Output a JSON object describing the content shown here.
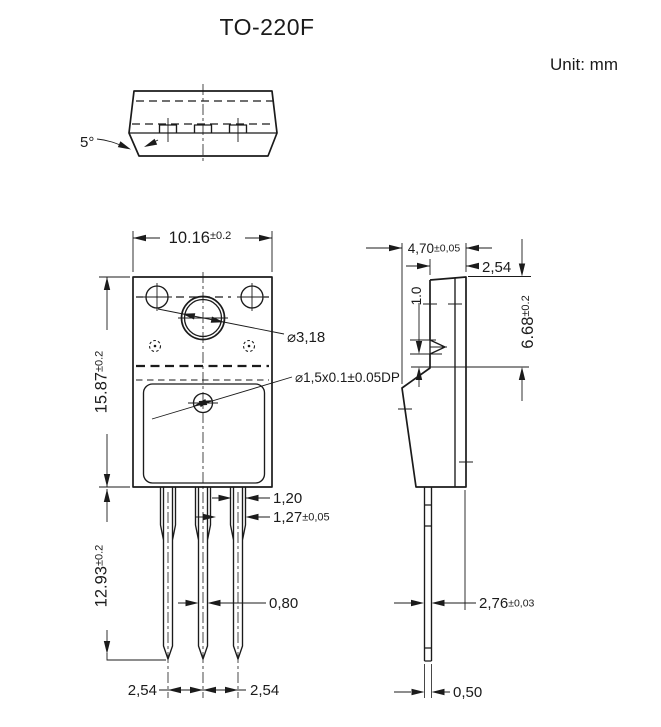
{
  "header": {
    "title": "TO-220F",
    "unit_label": "Unit: mm"
  },
  "top_view": {
    "draft_angle_label": "5°"
  },
  "front_view": {
    "width_dim": {
      "value": "10.16",
      "tol": "±0.2"
    },
    "body_height_dim": {
      "value": "15.87",
      "tol": "±0.2"
    },
    "lead_length_dim": {
      "value": "12.93",
      "tol": "±0.2"
    },
    "mounting_hole_label": "⌀3,18",
    "dimple_label": "⌀1,5x0.1±0.05DP",
    "lead_base_width_dim": "1,20",
    "lead_shoulder_width_dim": {
      "value": "1,27",
      "tol": "±0,05"
    },
    "lead_tip_width_dim": "0,80",
    "lead_pitch_left_dim": "2,54",
    "lead_pitch_right_dim": "2,54"
  },
  "side_view": {
    "body_thickness_dim": {
      "value": "4,70",
      "tol": "±0,05"
    },
    "tab_thickness_dim": "2,54",
    "dimple_offset_dim": "1.0",
    "flange_height_dim": {
      "value": "6.68",
      "tol": "±0.2"
    },
    "lead_offset_dim": {
      "value": "2,76",
      "tol": "±0,03"
    },
    "lead_thickness_dim": "0,50"
  },
  "colors": {
    "ink": "#1b1b1b",
    "background": "#ffffff"
  }
}
